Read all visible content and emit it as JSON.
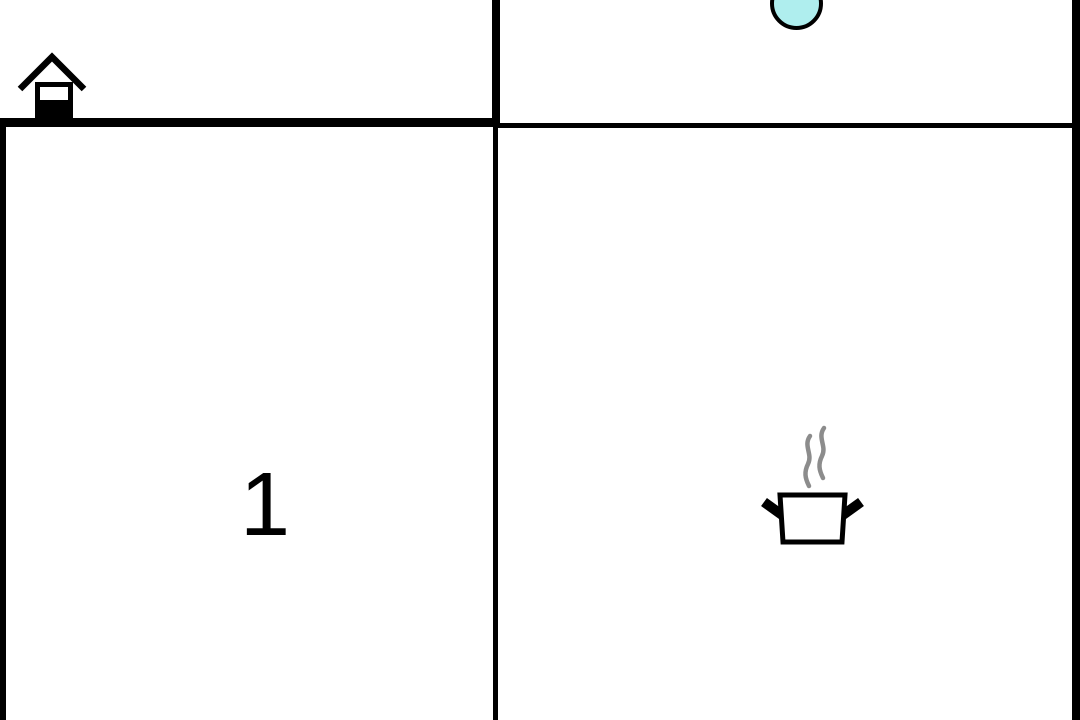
{
  "scene": {
    "type": "top-down-room-environment",
    "room_label": "1"
  },
  "icons": {
    "home": "house-with-door-icon",
    "agent": "cyan-ball",
    "stove": "pot-with-steam-icon"
  },
  "colors": {
    "wall": "#000000",
    "background": "#ffffff",
    "agent_fill": "#AFEEEE",
    "agent_stroke": "#000000",
    "steam": "#8c8c8c",
    "label": "#000000"
  }
}
